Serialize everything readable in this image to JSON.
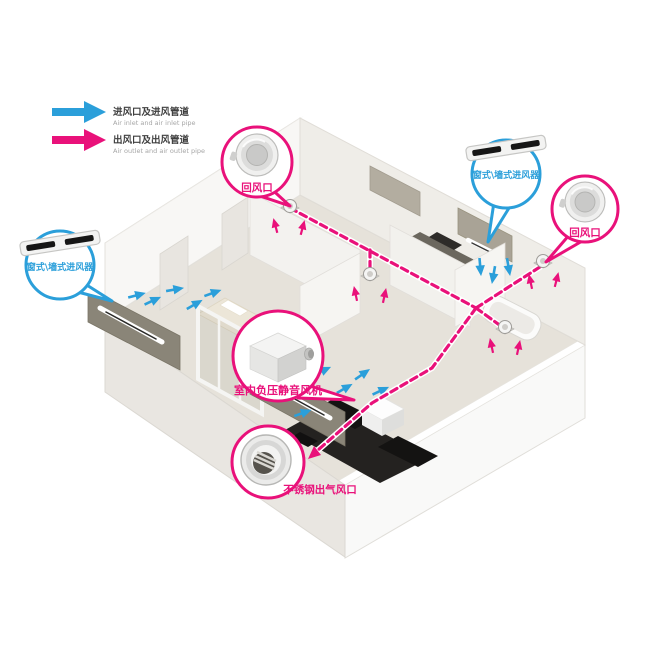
{
  "colors": {
    "inlet_blue": "#2b9fda",
    "outlet_magenta": "#e9117a"
  },
  "legend": {
    "items": [
      {
        "name": "air-inlet-and-pipe",
        "zh": "进风口及进风管道",
        "en": "Air inlet and air inlet pipe",
        "color": "#2b9fda"
      },
      {
        "name": "air-outlet-and-pipe",
        "zh": "出风口及出风管道",
        "en": "Air outlet and air outlet pipe",
        "color": "#e9117a"
      }
    ]
  },
  "callouts": {
    "return_air_top": {
      "label": "回风口",
      "device": "round-return-air-vent",
      "color": "#e9117a"
    },
    "window_wall_inlet_right": {
      "label": "窗式\\墙式进风器",
      "device": "slim-window-wall-air-inlet",
      "color": "#2b9fda"
    },
    "return_air_right": {
      "label": "回风口",
      "device": "round-return-air-vent",
      "color": "#e9117a"
    },
    "window_wall_inlet_left": {
      "label": "窗式\\墙式进风器",
      "device": "slim-window-wall-air-inlet",
      "color": "#2b9fda"
    },
    "indoor_fan": {
      "label": "室内负压静音风机",
      "device": "indoor-negative-pressure-silent-fan",
      "color": "#e9117a"
    },
    "stainless_outlet": {
      "label": "不锈钢出气风口",
      "device": "stainless-steel-round-air-outlet",
      "color": "#e9117a"
    }
  }
}
